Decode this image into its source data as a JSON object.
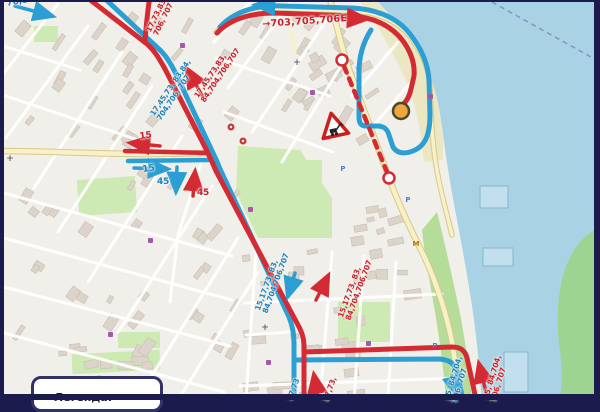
{
  "map": {
    "legend": {
      "title": "Легенда:"
    },
    "route_labels": {
      "corner_tl": "76,83",
      "north_branch": "17,73,83,\n706, 707",
      "north_main": "→703,705,706Е",
      "blvd_red": "17,45,73,83,\n84,704,706,707",
      "blvd_blue": "17,45,73, 83,84,\n704,706, 707",
      "west_red_15": "15",
      "west_blue_15": "15",
      "south_blue_45": "45",
      "south_red_45": "45",
      "mid_red": "15,17,73, 83,\n84,704,706,707",
      "mid_blue": "15,17,73, 83,\n84,704,706,707",
      "bottom_red": "17,73,",
      "bottom_blue": "17,73",
      "shore_red": "15, 84,704,\n706, 707",
      "shore_blue": "15, 84,704,\n706, 707"
    },
    "markers": {
      "parking": "P",
      "church_cross": "+",
      "restaurant_m": "M"
    },
    "colors": {
      "route_red": "#d42a33",
      "route_blue": "#2b9fd4",
      "label_red": "#c8202e",
      "label_blue": "#1a85c2",
      "water": "#a9d3e5",
      "terminus_orange": "#efa83d"
    }
  }
}
